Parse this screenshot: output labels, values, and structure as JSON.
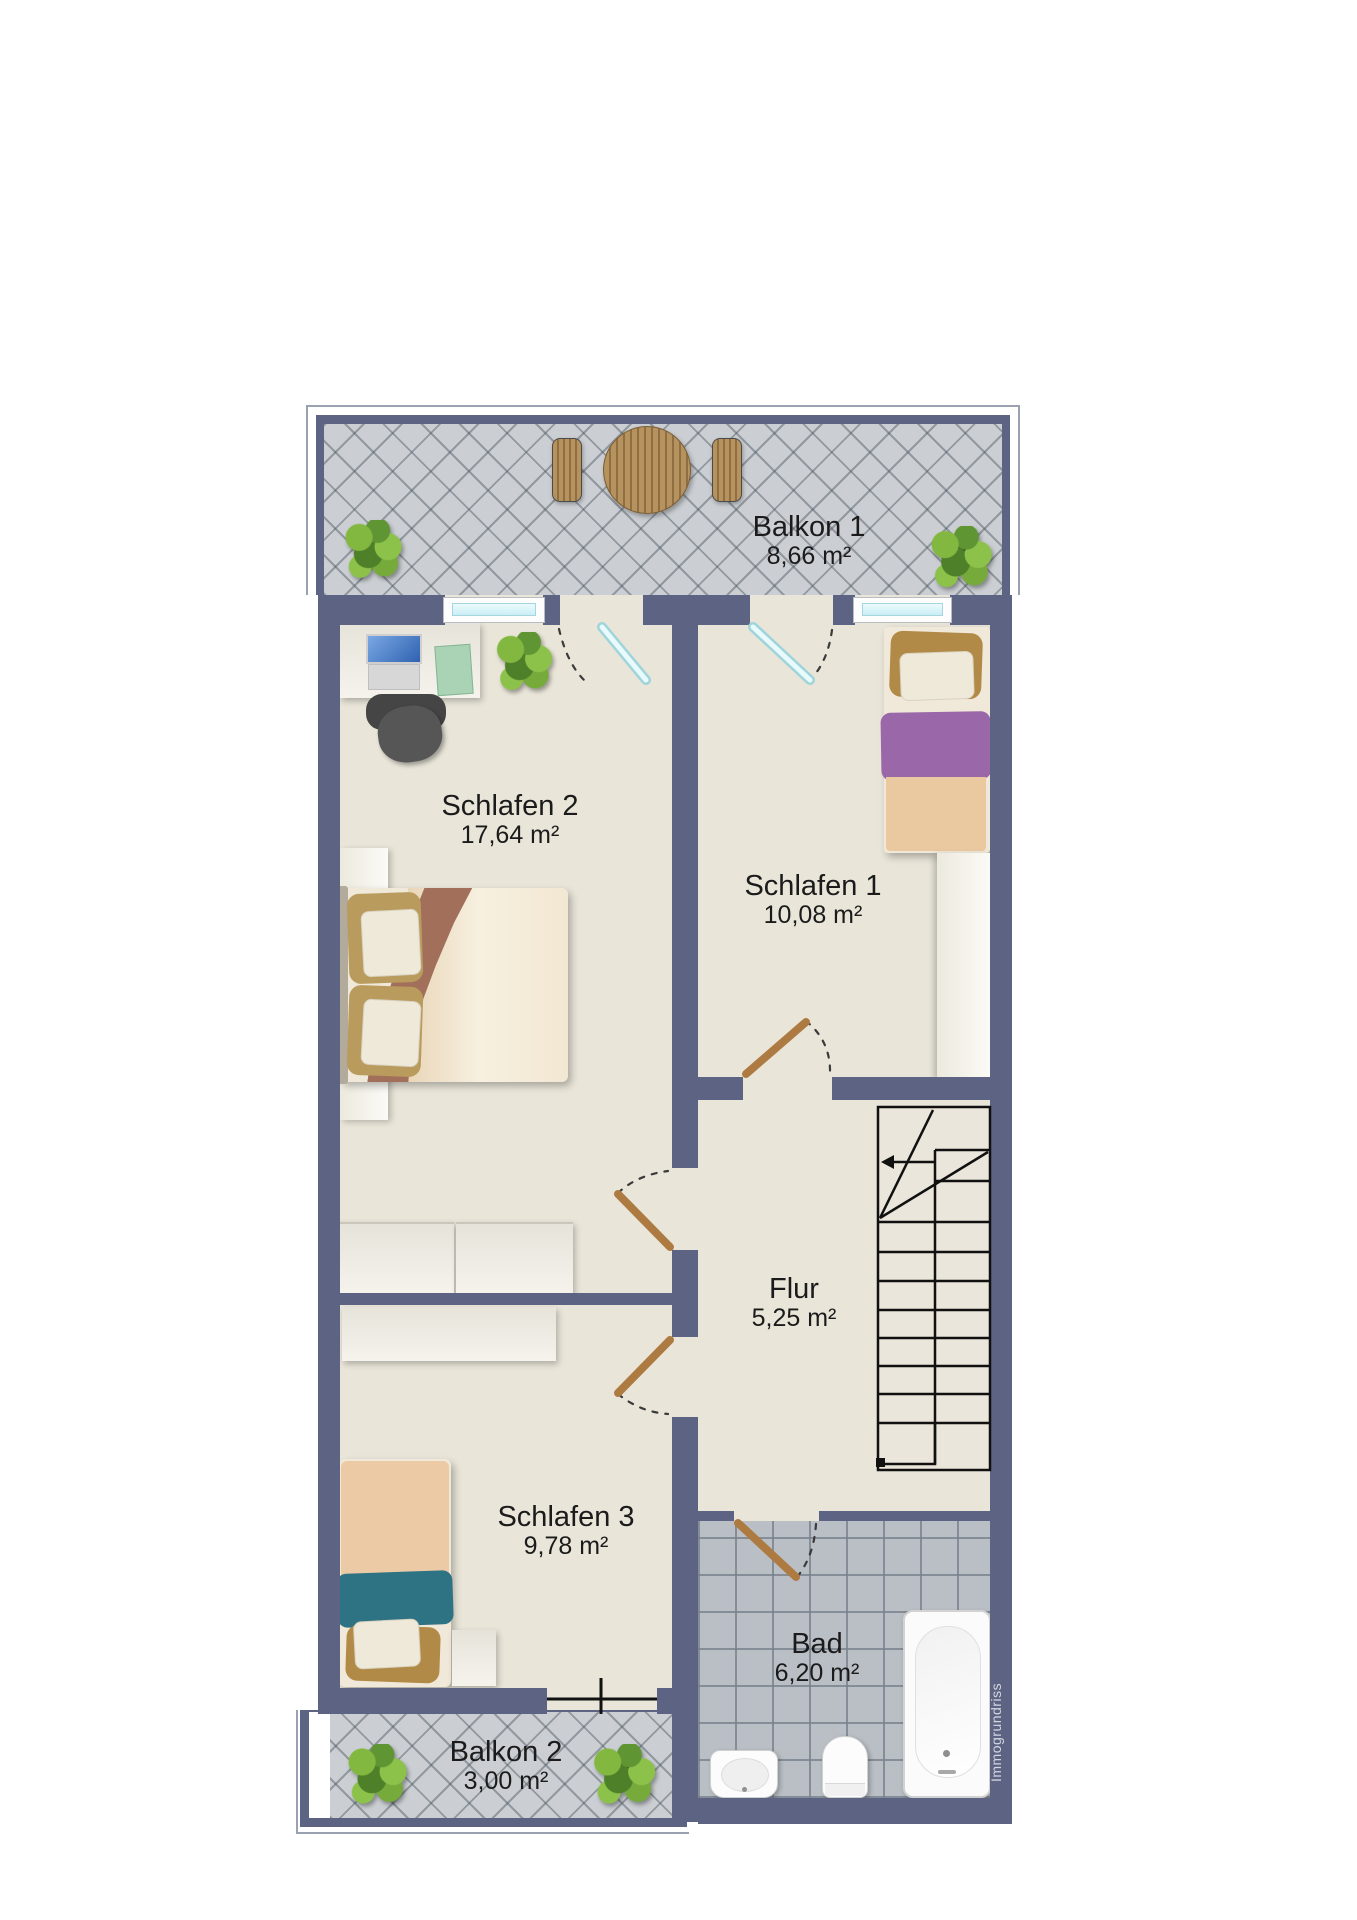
{
  "watermark": "Immogrundriss",
  "rooms": [
    {
      "id": "balkon-1",
      "name": "Balkon 1",
      "area": "8,66 m²"
    },
    {
      "id": "schlafen-2",
      "name": "Schlafen 2",
      "area": "17,64 m²"
    },
    {
      "id": "schlafen-1",
      "name": "Schlafen 1",
      "area": "10,08 m²"
    },
    {
      "id": "flur",
      "name": "Flur",
      "area": "5,25 m²"
    },
    {
      "id": "schlafen-3",
      "name": "Schlafen 3",
      "area": "9,78 m²"
    },
    {
      "id": "bad",
      "name": "Bad",
      "area": "6,20 m²"
    },
    {
      "id": "balkon-2",
      "name": "Balkon 2",
      "area": "3,00 m²"
    }
  ],
  "colors": {
    "wall": "#5d6382",
    "room_floor": "#e9e5d9",
    "balcony_tile": "#cbcfd3",
    "bath_tile": "#b9bfc5",
    "door_wood": "#ad7b42",
    "glass": "#d9f3f8",
    "label_text": "#1b1b1b",
    "watermark_text": "#d4d7e0"
  }
}
